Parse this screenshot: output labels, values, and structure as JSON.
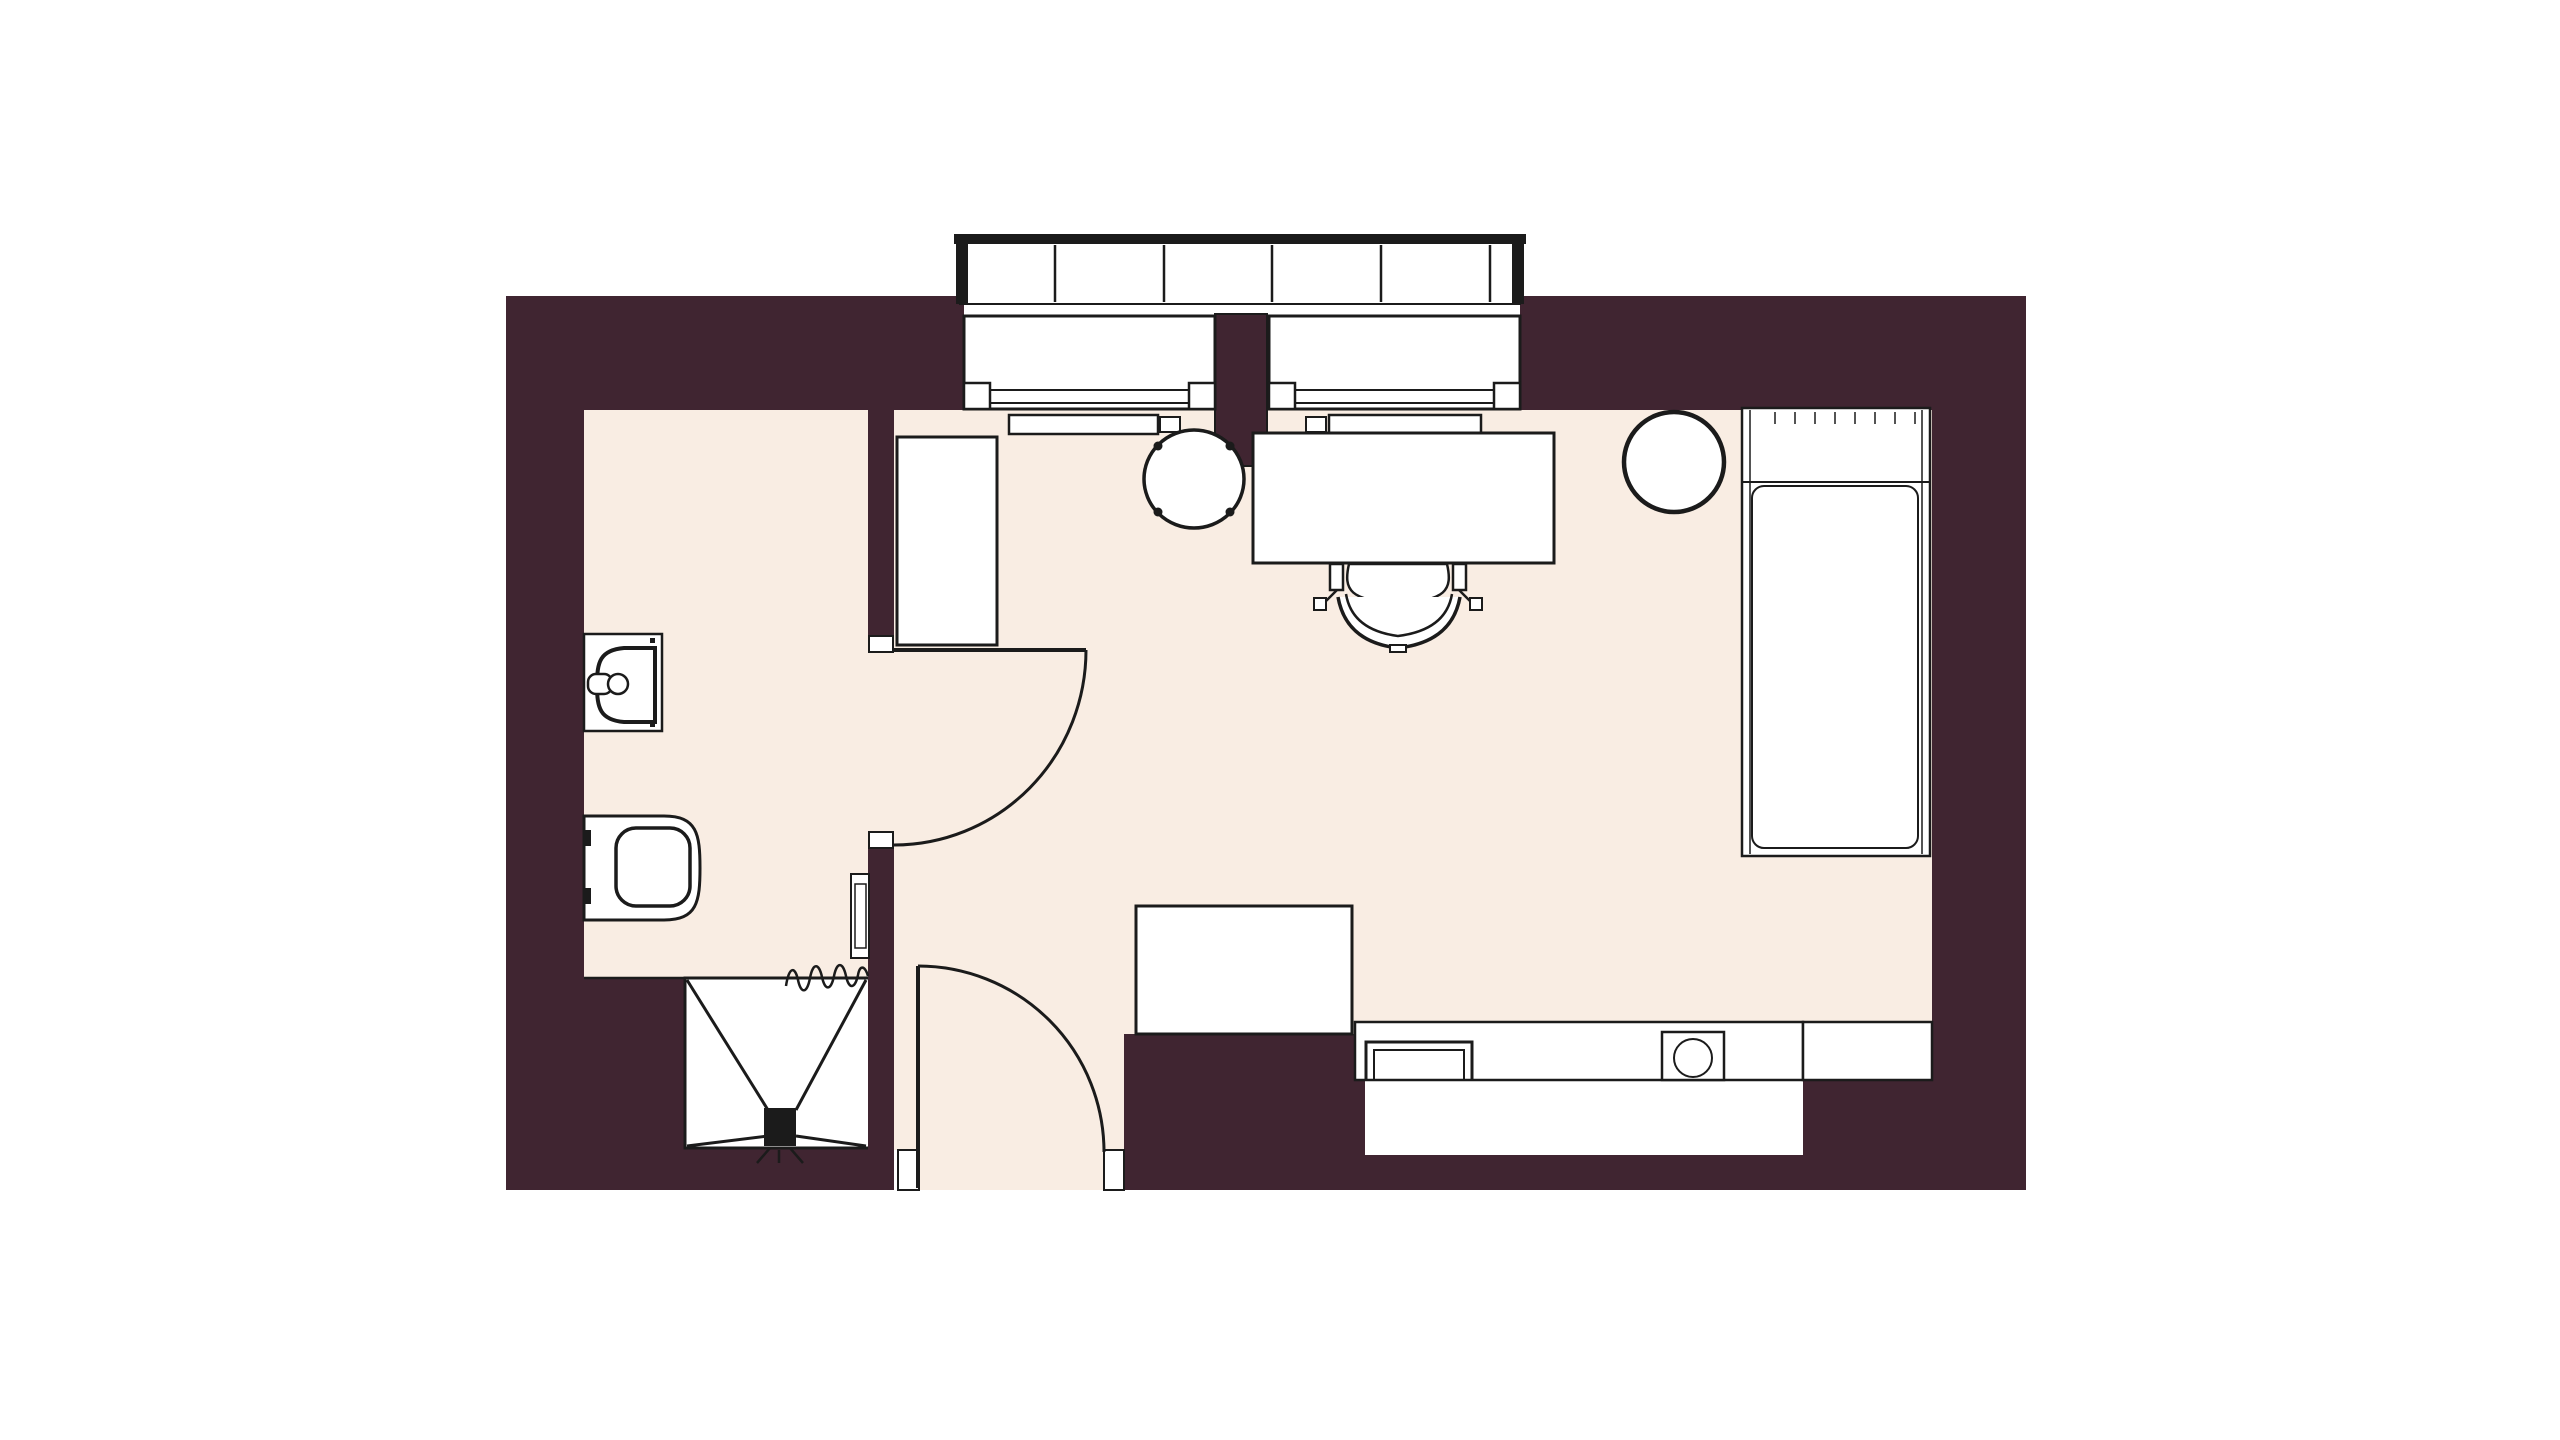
{
  "palette": {
    "background": "#ffffff",
    "wall": "#402531",
    "floor": "#f9ede3",
    "line": "#1b1b1b",
    "white": "#ffffff"
  },
  "canvas": {
    "width": 2560,
    "height": 1440
  },
  "elements": [
    {
      "name": "floor-bathroom",
      "kind": "rect",
      "x": 584,
      "y": 408,
      "w": 284,
      "h": 570,
      "fill": "floor"
    },
    {
      "name": "floor-main-room",
      "kind": "polygon",
      "points": "894,408 1932,408 1932,1022 1355,1022 1355,1034 1124,1034 1124,1150 1104,1150 1104,1190 919,1190 919,1150 894,1150",
      "fill": "floor"
    },
    {
      "name": "floor-bathroom-doorway",
      "kind": "rect",
      "x": 866,
      "y": 652,
      "w": 30,
      "h": 184,
      "fill": "floor"
    },
    {
      "name": "wall-top-left",
      "kind": "rect",
      "x": 506,
      "y": 296,
      "w": 458,
      "h": 114,
      "fill": "wall"
    },
    {
      "name": "wall-top-right",
      "kind": "rect",
      "x": 1520,
      "y": 296,
      "w": 506,
      "h": 114,
      "fill": "wall"
    },
    {
      "name": "wall-window-mullion",
      "kind": "rect",
      "x": 1215,
      "y": 314,
      "w": 52,
      "h": 152,
      "fill": "wall",
      "stroke": "line",
      "sw": 2
    },
    {
      "name": "wall-left",
      "kind": "rect",
      "x": 506,
      "y": 296,
      "w": 78,
      "h": 894,
      "fill": "wall"
    },
    {
      "name": "wall-right",
      "kind": "rect",
      "x": 1932,
      "y": 296,
      "w": 94,
      "h": 894,
      "fill": "wall"
    },
    {
      "name": "wall-divider-upper",
      "kind": "rect",
      "x": 868,
      "y": 408,
      "w": 26,
      "h": 232,
      "fill": "wall"
    },
    {
      "name": "wall-divider-lower",
      "kind": "rect",
      "x": 868,
      "y": 844,
      "w": 26,
      "h": 346,
      "fill": "wall"
    },
    {
      "name": "wall-bathroom-bottom",
      "kind": "rect",
      "x": 584,
      "y": 978,
      "w": 101,
      "h": 212,
      "fill": "wall"
    },
    {
      "name": "wall-under-shower",
      "kind": "rect",
      "x": 685,
      "y": 1148,
      "w": 183,
      "h": 42,
      "fill": "wall"
    },
    {
      "name": "wall-entry-right",
      "kind": "rect",
      "x": 1124,
      "y": 1034,
      "w": 241,
      "h": 156,
      "fill": "wall"
    },
    {
      "name": "kitchen-window-band",
      "kind": "rect",
      "x": 1365,
      "y": 1080,
      "w": 455,
      "h": 75,
      "fill": "white"
    },
    {
      "name": "wall-bottom-mid",
      "kind": "rect",
      "x": 1365,
      "y": 1155,
      "w": 455,
      "h": 35,
      "fill": "wall"
    },
    {
      "name": "wall-bottom-right",
      "kind": "rect",
      "x": 1803,
      "y": 1080,
      "w": 223,
      "h": 110,
      "fill": "wall"
    },
    {
      "name": "bathroom-floor-edge-line",
      "kind": "line",
      "x1": 584,
      "y1": 978,
      "x2": 685,
      "y2": 978,
      "sw": 2.5
    },
    {
      "name": "balcony-rail-body",
      "kind": "rect",
      "x": 960,
      "y": 242,
      "w": 560,
      "h": 62,
      "fill": "white",
      "stroke": "line",
      "sw": 2
    },
    {
      "name": "balcony-rail-top-bar",
      "kind": "rect",
      "x": 954,
      "y": 234,
      "w": 572,
      "h": 10,
      "fill": "line"
    },
    {
      "name": "balcony-rail-cap-left",
      "kind": "rect",
      "x": 956,
      "y": 234,
      "w": 12,
      "h": 70,
      "fill": "line"
    },
    {
      "name": "balcony-rail-cap-right",
      "kind": "rect",
      "x": 1512,
      "y": 234,
      "w": 12,
      "h": 70,
      "fill": "line"
    },
    {
      "name": "balcony-rail-divider-1",
      "kind": "line",
      "x1": 1055,
      "y1": 245,
      "x2": 1055,
      "y2": 302,
      "sw": 2.5
    },
    {
      "name": "balcony-rail-divider-2",
      "kind": "line",
      "x1": 1164,
      "y1": 245,
      "x2": 1164,
      "y2": 302,
      "sw": 2.5
    },
    {
      "name": "balcony-rail-divider-3",
      "kind": "line",
      "x1": 1272,
      "y1": 245,
      "x2": 1272,
      "y2": 302,
      "sw": 2.5
    },
    {
      "name": "balcony-rail-divider-4",
      "kind": "line",
      "x1": 1381,
      "y1": 245,
      "x2": 1381,
      "y2": 302,
      "sw": 2.5
    },
    {
      "name": "balcony-rail-divider-5",
      "kind": "line",
      "x1": 1490,
      "y1": 245,
      "x2": 1490,
      "y2": 302,
      "sw": 2.5
    },
    {
      "name": "window-left-frame",
      "kind": "rect",
      "x": 964,
      "y": 316,
      "w": 251,
      "h": 93,
      "fill": "white",
      "stroke": "line",
      "sw": 3
    },
    {
      "name": "window-left-glass-outer",
      "kind": "line",
      "x1": 990,
      "y1": 390,
      "x2": 1189,
      "y2": 390,
      "sw": 2
    },
    {
      "name": "window-left-glass-inner",
      "kind": "line",
      "x1": 990,
      "y1": 403,
      "x2": 1189,
      "y2": 403,
      "sw": 2
    },
    {
      "name": "window-left-jamb-left",
      "kind": "rect",
      "x": 964,
      "y": 383,
      "w": 26,
      "h": 26,
      "fill": "white",
      "stroke": "line",
      "sw": 2.5
    },
    {
      "name": "window-left-jamb-right",
      "kind": "rect",
      "x": 1189,
      "y": 383,
      "w": 26,
      "h": 26,
      "fill": "white",
      "stroke": "line",
      "sw": 2.5
    },
    {
      "name": "window-right-frame",
      "kind": "rect",
      "x": 1269,
      "y": 316,
      "w": 251,
      "h": 93,
      "fill": "white",
      "stroke": "line",
      "sw": 3
    },
    {
      "name": "window-right-glass-outer",
      "kind": "line",
      "x1": 1295,
      "y1": 390,
      "x2": 1494,
      "y2": 390,
      "sw": 2
    },
    {
      "name": "window-right-glass-inner",
      "kind": "line",
      "x1": 1295,
      "y1": 403,
      "x2": 1494,
      "y2": 403,
      "sw": 2
    },
    {
      "name": "window-right-jamb-left",
      "kind": "rect",
      "x": 1269,
      "y": 383,
      "w": 26,
      "h": 26,
      "fill": "white",
      "stroke": "line",
      "sw": 2.5
    },
    {
      "name": "window-right-jamb-right",
      "kind": "rect",
      "x": 1494,
      "y": 383,
      "w": 26,
      "h": 26,
      "fill": "white",
      "stroke": "line",
      "sw": 2.5
    },
    {
      "name": "radiator-left-body",
      "kind": "rect",
      "x": 1009,
      "y": 415,
      "w": 149,
      "h": 19,
      "fill": "white",
      "stroke": "line",
      "sw": 2.5
    },
    {
      "name": "radiator-left-valve",
      "kind": "rect",
      "x": 1160,
      "y": 417,
      "w": 20,
      "h": 15,
      "fill": "white",
      "stroke": "line",
      "sw": 2
    },
    {
      "name": "radiator-right-valve",
      "kind": "rect",
      "x": 1306,
      "y": 417,
      "w": 20,
      "h": 15,
      "fill": "white",
      "stroke": "line",
      "sw": 2
    },
    {
      "name": "radiator-right-body",
      "kind": "rect",
      "x": 1329,
      "y": 415,
      "w": 152,
      "h": 19,
      "fill": "white",
      "stroke": "line",
      "sw": 2.5
    },
    {
      "name": "doorjamb-bathroom-top",
      "kind": "rect",
      "x": 869,
      "y": 636,
      "w": 24,
      "h": 16,
      "fill": "white",
      "stroke": "line",
      "sw": 2
    },
    {
      "name": "doorjamb-bathroom-bottom",
      "kind": "rect",
      "x": 869,
      "y": 832,
      "w": 24,
      "h": 16,
      "fill": "white",
      "stroke": "line",
      "sw": 2
    },
    {
      "name": "door-bathroom-leaf",
      "kind": "line",
      "x1": 894,
      "y1": 650,
      "x2": 1086,
      "y2": 650,
      "sw": 4
    },
    {
      "name": "door-bathroom-swing-arc",
      "kind": "path",
      "d": "M1086,650 A192,195 0 0 1 894,845",
      "fill": "none",
      "sw": 3
    },
    {
      "name": "doorjamb-entry-left",
      "kind": "rect",
      "x": 898,
      "y": 1150,
      "w": 21,
      "h": 40,
      "fill": "white",
      "stroke": "line",
      "sw": 2
    },
    {
      "name": "doorjamb-entry-right",
      "kind": "rect",
      "x": 1104,
      "y": 1150,
      "w": 20,
      "h": 40,
      "fill": "white",
      "stroke": "line",
      "sw": 2
    },
    {
      "name": "door-entry-leaf",
      "kind": "line",
      "x1": 918,
      "y1": 966,
      "x2": 918,
      "y2": 1188,
      "sw": 4
    },
    {
      "name": "door-entry-swing-arc",
      "kind": "path",
      "d": "M918,966 A186,186 0 0 1 1104,1152",
      "fill": "none",
      "sw": 3
    },
    {
      "name": "wardrobe",
      "kind": "rect",
      "x": 897,
      "y": 437,
      "w": 100,
      "h": 208,
      "fill": "white",
      "stroke": "line",
      "sw": 3
    },
    {
      "name": "side-table",
      "kind": "ellipse",
      "cx": 1194,
      "cy": 479,
      "rx": 50,
      "ry": 49,
      "fill": "white",
      "stroke": "line",
      "sw": 3.5
    },
    {
      "name": "side-table-dot-ne",
      "kind": "circle",
      "cx": 1230,
      "cy": 446,
      "r": 4.5,
      "fill": "line"
    },
    {
      "name": "side-table-dot-nw",
      "kind": "circle",
      "cx": 1158,
      "cy": 446,
      "r": 4.5,
      "fill": "line"
    },
    {
      "name": "side-table-dot-sw",
      "kind": "circle",
      "cx": 1158,
      "cy": 512,
      "r": 4.5,
      "fill": "line"
    },
    {
      "name": "side-table-dot-se",
      "kind": "circle",
      "cx": 1230,
      "cy": 512,
      "r": 4.5,
      "fill": "line"
    },
    {
      "name": "desk",
      "kind": "rect",
      "x": 1253,
      "y": 433,
      "w": 301,
      "h": 130,
      "fill": "white",
      "stroke": "line",
      "sw": 3
    },
    {
      "name": "desk-chair-seat",
      "kind": "path",
      "d": "M1349,564 H1447 C1453,590 1446,601 1398,603 C1350,601 1343,590 1349,564 Z",
      "fill": "white",
      "sw": 2.5
    },
    {
      "name": "desk-chair-arm-left",
      "kind": "rect",
      "x": 1330,
      "y": 564,
      "w": 13,
      "h": 26,
      "fill": "white",
      "stroke": "line",
      "sw": 2.5
    },
    {
      "name": "desk-chair-arm-right",
      "kind": "rect",
      "x": 1453,
      "y": 564,
      "w": 13,
      "h": 26,
      "fill": "white",
      "stroke": "line",
      "sw": 2.5
    },
    {
      "name": "desk-chair-casters",
      "kind": "path",
      "d": "M1337,590 L1325,602 M1459,590 L1471,602",
      "fill": "none",
      "sw": 2.5
    },
    {
      "name": "desk-chair-foot-left",
      "kind": "rect",
      "x": 1314,
      "y": 598,
      "w": 12,
      "h": 12,
      "fill": "white",
      "stroke": "line",
      "sw": 2
    },
    {
      "name": "desk-chair-foot-right",
      "kind": "rect",
      "x": 1470,
      "y": 598,
      "w": 12,
      "h": 12,
      "fill": "white",
      "stroke": "line",
      "sw": 2
    },
    {
      "name": "desk-chair-back-outer",
      "kind": "path",
      "d": "M1338,597 Q1346,642 1398,648 Q1452,642 1460,597",
      "fill": "white",
      "sw": 3.5
    },
    {
      "name": "desk-chair-back-inner",
      "kind": "path",
      "d": "M1346,594 Q1352,630 1398,636 Q1446,630 1452,594",
      "fill": "none",
      "sw": 2.5
    },
    {
      "name": "desk-chair-back-nub",
      "kind": "rect",
      "x": 1390,
      "y": 645,
      "w": 16,
      "h": 7,
      "fill": "white",
      "stroke": "line",
      "sw": 2
    },
    {
      "name": "stool",
      "kind": "circle",
      "cx": 1674,
      "cy": 462,
      "r": 50,
      "fill": "white",
      "stroke": "line",
      "sw": 4.5
    },
    {
      "name": "bed-frame",
      "kind": "rect",
      "x": 1742,
      "y": 408,
      "w": 188,
      "h": 448,
      "fill": "white",
      "stroke": "line",
      "sw": 2.5
    },
    {
      "name": "bed-inner-edge-left",
      "kind": "line",
      "x1": 1750,
      "y1": 410,
      "x2": 1750,
      "y2": 854,
      "sw": 1.5
    },
    {
      "name": "bed-inner-edge-right",
      "kind": "line",
      "x1": 1922,
      "y1": 410,
      "x2": 1922,
      "y2": 854,
      "sw": 1.5
    },
    {
      "name": "bed-pillow-line",
      "kind": "line",
      "x1": 1742,
      "y1": 482,
      "x2": 1930,
      "y2": 482,
      "sw": 2
    },
    {
      "name": "bed-mattress",
      "kind": "rect",
      "x": 1752,
      "y": 486,
      "w": 166,
      "h": 362,
      "rx": 12,
      "fill": "none",
      "stroke": "line",
      "sw": 2
    },
    {
      "name": "bed-head-ticks",
      "kind": "path",
      "d": "M1775,412 V424 M1795,412 V424 M1815,412 V424 M1835,412 V424 M1855,412 V424 M1875,412 V424 M1895,412 V424 M1915,412 V424",
      "fill": "none",
      "sw": 1.5
    },
    {
      "name": "entry-cabinet",
      "kind": "rect",
      "x": 1136,
      "y": 906,
      "w": 216,
      "h": 128,
      "fill": "white",
      "stroke": "line",
      "sw": 3
    },
    {
      "name": "kitchen-counter",
      "kind": "rect",
      "x": 1355,
      "y": 1022,
      "w": 448,
      "h": 58,
      "fill": "white",
      "stroke": "line",
      "sw": 2.5
    },
    {
      "name": "kitchen-fridge",
      "kind": "rect",
      "x": 1803,
      "y": 1022,
      "w": 129,
      "h": 58,
      "fill": "white",
      "stroke": "line",
      "sw": 2.5
    },
    {
      "name": "kitchen-sink-outer",
      "kind": "path",
      "d": "M1366,1080 V1042 H1472 V1080",
      "fill": "none",
      "sw": 3
    },
    {
      "name": "kitchen-sink-inner",
      "kind": "path",
      "d": "M1374,1080 V1050 H1464 V1080",
      "fill": "none",
      "sw": 2
    },
    {
      "name": "cooktop",
      "kind": "rect",
      "x": 1662,
      "y": 1032,
      "w": 62,
      "h": 48,
      "fill": "white",
      "stroke": "line",
      "sw": 2.5
    },
    {
      "name": "cooktop-burner",
      "kind": "circle",
      "cx": 1693,
      "cy": 1058,
      "r": 19,
      "fill": "none",
      "stroke": "line",
      "sw": 2
    },
    {
      "name": "towel-rail-outer",
      "kind": "rect",
      "x": 851,
      "y": 874,
      "w": 18,
      "h": 84,
      "fill": "white",
      "stroke": "line",
      "sw": 2
    },
    {
      "name": "towel-rail-inner",
      "kind": "rect",
      "x": 855,
      "y": 884,
      "w": 11,
      "h": 64,
      "fill": "none",
      "stroke": "line",
      "sw": 1.5
    },
    {
      "name": "bathroom-sink-counter",
      "kind": "rect",
      "x": 584,
      "y": 634,
      "w": 78,
      "h": 97,
      "fill": "white",
      "stroke": "line",
      "sw": 2.5
    },
    {
      "name": "bathroom-sink-basin",
      "kind": "path",
      "d": "M655,648 H624 C600,650 597,662 597,685 C597,708 600,720 624,722 H655 Z",
      "fill": "white",
      "sw": 4
    },
    {
      "name": "bathroom-sink-faucet-base",
      "kind": "rect",
      "x": 588,
      "y": 674,
      "w": 24,
      "h": 20,
      "rx": 8,
      "fill": "white",
      "stroke": "line",
      "sw": 2.5
    },
    {
      "name": "bathroom-sink-faucet-knob",
      "kind": "circle",
      "cx": 618,
      "cy": 684,
      "r": 10,
      "fill": "white",
      "stroke": "line",
      "sw": 2.5
    },
    {
      "name": "bathroom-sink-dot-top",
      "kind": "rect",
      "x": 650,
      "y": 638,
      "w": 5,
      "h": 5,
      "fill": "line"
    },
    {
      "name": "bathroom-sink-dot-bottom",
      "kind": "rect",
      "x": 650,
      "y": 722,
      "w": 5,
      "h": 5,
      "fill": "line"
    },
    {
      "name": "toilet-body",
      "kind": "path",
      "d": "M584,816 H664 C697,816 700,834 700,868 C700,902 697,920 664,920 H584 Z",
      "fill": "white",
      "sw": 3
    },
    {
      "name": "toilet-seat",
      "kind": "rect",
      "x": 616,
      "y": 828,
      "w": 74,
      "h": 78,
      "rx": 20,
      "fill": "white",
      "stroke": "line",
      "sw": 3.5
    },
    {
      "name": "toilet-mount-top",
      "kind": "rect",
      "x": 584,
      "y": 830,
      "w": 7,
      "h": 16,
      "fill": "line"
    },
    {
      "name": "toilet-mount-bottom",
      "kind": "rect",
      "x": 584,
      "y": 888,
      "w": 7,
      "h": 16,
      "fill": "line"
    },
    {
      "name": "shower-border",
      "kind": "path",
      "d": "M868,978 H685 V1148 H868",
      "fill": "none",
      "sw": 3
    },
    {
      "name": "shower-diagonal-top-left",
      "kind": "line",
      "x1": 687,
      "y1": 980,
      "x2": 768,
      "y2": 1110,
      "sw": 3
    },
    {
      "name": "shower-diagonal-top-right",
      "kind": "line",
      "x1": 866,
      "y1": 980,
      "x2": 796,
      "y2": 1110,
      "sw": 3
    },
    {
      "name": "shower-diagonal-bottom-left",
      "kind": "line",
      "x1": 687,
      "y1": 1146,
      "x2": 768,
      "y2": 1136,
      "sw": 3
    },
    {
      "name": "shower-diagonal-bottom-right",
      "kind": "line",
      "x1": 866,
      "y1": 1146,
      "x2": 796,
      "y2": 1136,
      "sw": 3
    },
    {
      "name": "shower-drain",
      "kind": "rect",
      "x": 764,
      "y": 1108,
      "w": 32,
      "h": 38,
      "fill": "line"
    },
    {
      "name": "shower-drain-feet",
      "kind": "path",
      "d": "M770,1148 L757,1163 M790,1148 L803,1163 M779,1150 V1163",
      "fill": "none",
      "sw": 2.5
    },
    {
      "name": "shower-curtain-squiggle",
      "kind": "path",
      "d": "M786,986 C789,966 795,966 798,980 C801,994 807,994 810,978 C813,962 819,963 822,977 C825,991 831,991 834,976 C837,961 843,962 846,976 C849,990 855,989 858,975 C860,964 865,966 868,976",
      "fill": "none",
      "sw": 2.5
    }
  ]
}
